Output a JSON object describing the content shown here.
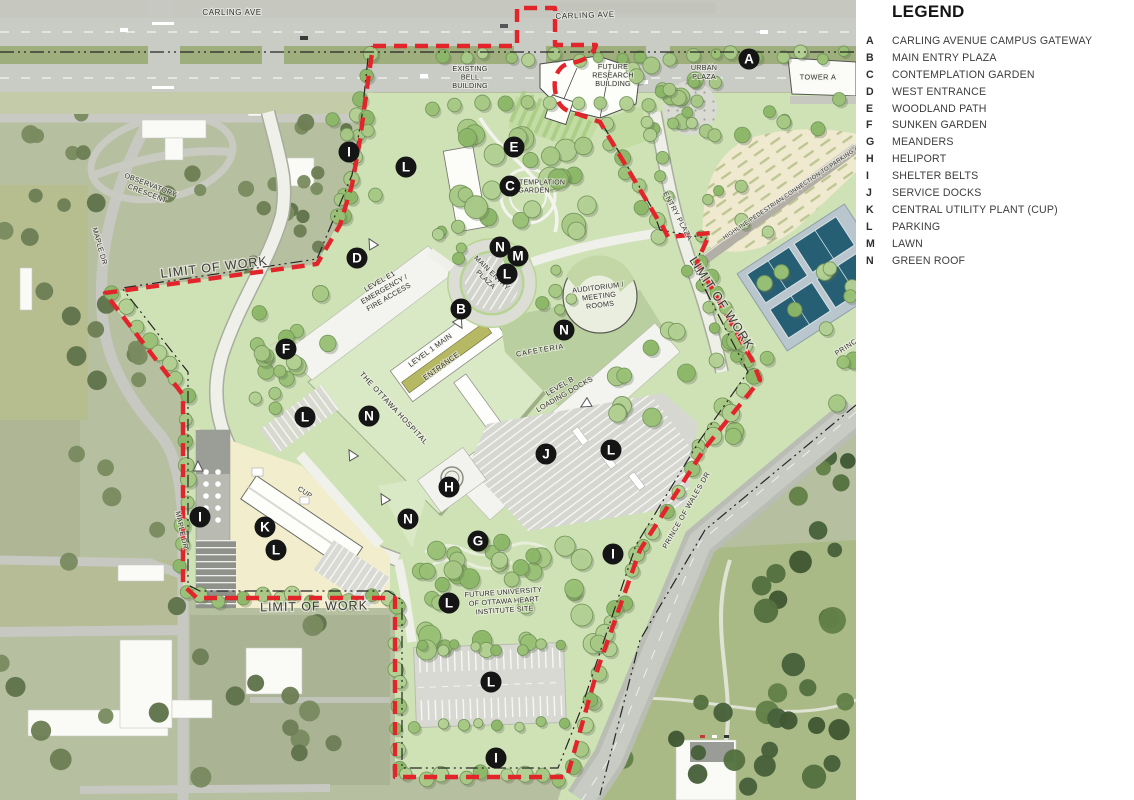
{
  "legend": {
    "title": "LEGEND",
    "items": [
      {
        "key": "A",
        "label": "CARLING AVENUE CAMPUS GATEWAY"
      },
      {
        "key": "B",
        "label": "MAIN ENTRY PLAZA"
      },
      {
        "key": "C",
        "label": "CONTEMPLATION GARDEN"
      },
      {
        "key": "D",
        "label": "WEST ENTRANCE"
      },
      {
        "key": "E",
        "label": "WOODLAND PATH"
      },
      {
        "key": "F",
        "label": "SUNKEN GARDEN"
      },
      {
        "key": "G",
        "label": "MEANDERS"
      },
      {
        "key": "H",
        "label": "HELIPORT"
      },
      {
        "key": "I",
        "label": "SHELTER BELTS"
      },
      {
        "key": "J",
        "label": "SERVICE DOCKS"
      },
      {
        "key": "K",
        "label": "CENTRAL UTILITY PLANT (CUP)"
      },
      {
        "key": "L",
        "label": "PARKING"
      },
      {
        "key": "M",
        "label": "LAWN"
      },
      {
        "key": "N",
        "label": "GREEN ROOF"
      }
    ]
  },
  "map": {
    "colors": {
      "limit_line": "#e2242b",
      "boundary_dash": "#262626",
      "marker_bg": "#151515",
      "marker_letter": "#ffffff",
      "site_green": "#cfe2b6",
      "tree_green": "#9cc07c",
      "court_blue": "#265e74",
      "lawn_beige": "#efe9d0",
      "cup_yellow": "#f2eecd",
      "road_gray": "#c9cbc5",
      "label_text": "#2f2f2f"
    },
    "markers": [
      {
        "letter": "A",
        "x": 749,
        "y": 59
      },
      {
        "letter": "I",
        "x": 349,
        "y": 152
      },
      {
        "letter": "L",
        "x": 406,
        "y": 167
      },
      {
        "letter": "E",
        "x": 514,
        "y": 147
      },
      {
        "letter": "C",
        "x": 510,
        "y": 186
      },
      {
        "letter": "D",
        "x": 357,
        "y": 258
      },
      {
        "letter": "N",
        "x": 500,
        "y": 247
      },
      {
        "letter": "M",
        "x": 518,
        "y": 256
      },
      {
        "letter": "L",
        "x": 507,
        "y": 274
      },
      {
        "letter": "B",
        "x": 461,
        "y": 309
      },
      {
        "letter": "F",
        "x": 286,
        "y": 349
      },
      {
        "letter": "N",
        "x": 564,
        "y": 330
      },
      {
        "letter": "L",
        "x": 305,
        "y": 417
      },
      {
        "letter": "N",
        "x": 369,
        "y": 416
      },
      {
        "letter": "J",
        "x": 546,
        "y": 454
      },
      {
        "letter": "L",
        "x": 611,
        "y": 450
      },
      {
        "letter": "H",
        "x": 449,
        "y": 487
      },
      {
        "letter": "N",
        "x": 408,
        "y": 519
      },
      {
        "letter": "I",
        "x": 200,
        "y": 517
      },
      {
        "letter": "K",
        "x": 265,
        "y": 527
      },
      {
        "letter": "L",
        "x": 276,
        "y": 550
      },
      {
        "letter": "G",
        "x": 478,
        "y": 541
      },
      {
        "letter": "I",
        "x": 613,
        "y": 554
      },
      {
        "letter": "L",
        "x": 449,
        "y": 603
      },
      {
        "letter": "L",
        "x": 491,
        "y": 682
      },
      {
        "letter": "I",
        "x": 496,
        "y": 758
      }
    ],
    "labels": [
      {
        "text": "CARLING AVE",
        "x": 232,
        "y": 12,
        "rot": 0,
        "size": 8,
        "ls": 0.6
      },
      {
        "text": "CARLING AVE",
        "x": 585,
        "y": 15,
        "rot": -2,
        "size": 8,
        "ls": 0.6
      },
      {
        "text": "EXISTING\nBELL\nBUILDING",
        "x": 470,
        "y": 77,
        "rot": 0,
        "size": 7.2,
        "lh": 8.6
      },
      {
        "text": "FUTURE\nRESEARCH\nBUILDING",
        "x": 613,
        "y": 75,
        "rot": 0,
        "size": 7.2,
        "lh": 8.6
      },
      {
        "text": "URBAN\nPLAZA",
        "x": 704,
        "y": 72,
        "rot": 0,
        "size": 7.2,
        "lh": 8.6
      },
      {
        "text": "TOWER A",
        "x": 818,
        "y": 77,
        "rot": 0,
        "size": 7.2,
        "ls": 0.5
      },
      {
        "text": "OBSERVATORY\nCRESCENT",
        "x": 149,
        "y": 189,
        "rot": 21,
        "size": 7.2,
        "lh": 9
      },
      {
        "text": "MAPLE DR",
        "x": 100,
        "y": 246,
        "rot": 74,
        "size": 7.2
      },
      {
        "text": "MAPLE DR",
        "x": 182,
        "y": 530,
        "rot": 78,
        "size": 7.2
      },
      {
        "text": "LIMIT OF WORK",
        "x": 214,
        "y": 267,
        "rot": -7,
        "size": 12.5,
        "ls": 1,
        "cls": "limit"
      },
      {
        "text": "LIMIT OF WORK",
        "x": 314,
        "y": 606,
        "rot": -1,
        "size": 12.5,
        "ls": 1,
        "cls": "limit"
      },
      {
        "text": "LIMIT OF WORK",
        "x": 722,
        "y": 303,
        "rot": 57,
        "size": 12.5,
        "ls": 1,
        "cls": "limit"
      },
      {
        "text": "ENTRY PLAZA",
        "x": 678,
        "y": 216,
        "rot": 62,
        "size": 7.2,
        "ls": 0.5
      },
      {
        "text": "HIGHLINE PEDESTRIAN CONNECTION TO PARKING & L",
        "x": 793,
        "y": 191,
        "rot": -34,
        "size": 6
      },
      {
        "text": "CONTEMPLATION\nGARDEN",
        "x": 534,
        "y": 186,
        "rot": 0,
        "size": 7,
        "lh": 8.4
      },
      {
        "text": "LEVEL E1\nEMERGENCY /\nFIRE ACCESS",
        "x": 384,
        "y": 289,
        "rot": -30,
        "size": 7.2,
        "lh": 9
      },
      {
        "text": "MAIN ENTRY\nPLAZA",
        "x": 489,
        "y": 276,
        "rot": 44,
        "size": 7.2,
        "lh": 9
      },
      {
        "text": "AUDITORIUM /\nMEETING\nROOMS",
        "x": 599,
        "y": 296,
        "rot": -7,
        "size": 7.2,
        "lh": 8.8
      },
      {
        "text": "CAFETERIA",
        "x": 540,
        "y": 350,
        "rot": -10,
        "size": 7.4,
        "ls": 0.8
      },
      {
        "text": "LEVEL 1 MAIN",
        "x": 430,
        "y": 350,
        "rot": -36,
        "size": 7.4
      },
      {
        "text": "ENTRANCE",
        "x": 441,
        "y": 366,
        "rot": -36,
        "size": 7.4
      },
      {
        "text": "THE OTTAWA HOSPITAL",
        "x": 394,
        "y": 408,
        "rot": 47,
        "size": 7.4,
        "ls": 0.6
      },
      {
        "text": "LEVEL B\nLOADING DOCKS",
        "x": 562,
        "y": 390,
        "rot": -30,
        "size": 7.4,
        "lh": 9.4
      },
      {
        "text": "CUP",
        "x": 305,
        "y": 492,
        "rot": 34,
        "size": 7
      },
      {
        "text": "FUTURE UNIVERSITY\nOF OTTAWA HEART\nINSTITUTE SITE",
        "x": 504,
        "y": 601,
        "rot": -4,
        "size": 7.2,
        "lh": 9
      },
      {
        "text": "PRINCE OF WALES DR",
        "x": 686,
        "y": 510,
        "rot": -60,
        "size": 7.2,
        "ls": 0.5
      },
      {
        "text": "PRINCE OF WALES DR",
        "x": 872,
        "y": 330,
        "rot": -33,
        "size": 7.2,
        "ls": 0.5
      }
    ]
  }
}
